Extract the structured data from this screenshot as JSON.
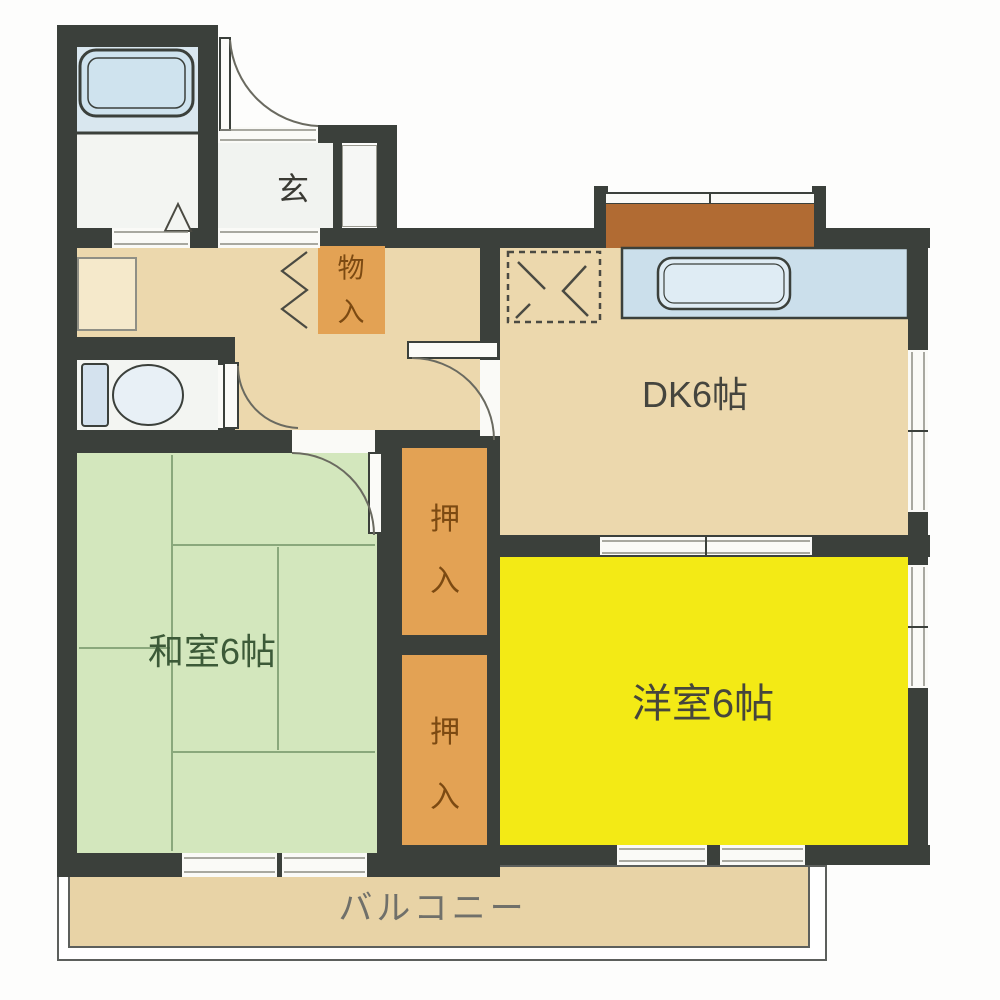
{
  "floorplan": {
    "rooms": {
      "dk": {
        "label": "DK6帖"
      },
      "western_room": {
        "label": "洋室6帖"
      },
      "japanese_room": {
        "label": "和室6帖"
      },
      "entrance": {
        "label": "玄"
      },
      "storage": {
        "chars": [
          "物",
          "入"
        ]
      },
      "closet_upper": {
        "chars": [
          "押",
          "入"
        ]
      },
      "closet_lower": {
        "chars": [
          "押",
          "入"
        ]
      },
      "balcony": {
        "label": "バルコニー"
      }
    },
    "colors": {
      "wall": "#3b403b",
      "floor_tan": "#ecd8ad",
      "tatami_green": "#d3e7bd",
      "western_yellow": "#f3ea15",
      "closet_orange": "#e3a254",
      "counter_blue": "#cbdfeb",
      "bath_blue": "#d9e7ef",
      "balcony_tan": "#e8d3a6",
      "bay_window_brown": "#b16b33"
    }
  }
}
